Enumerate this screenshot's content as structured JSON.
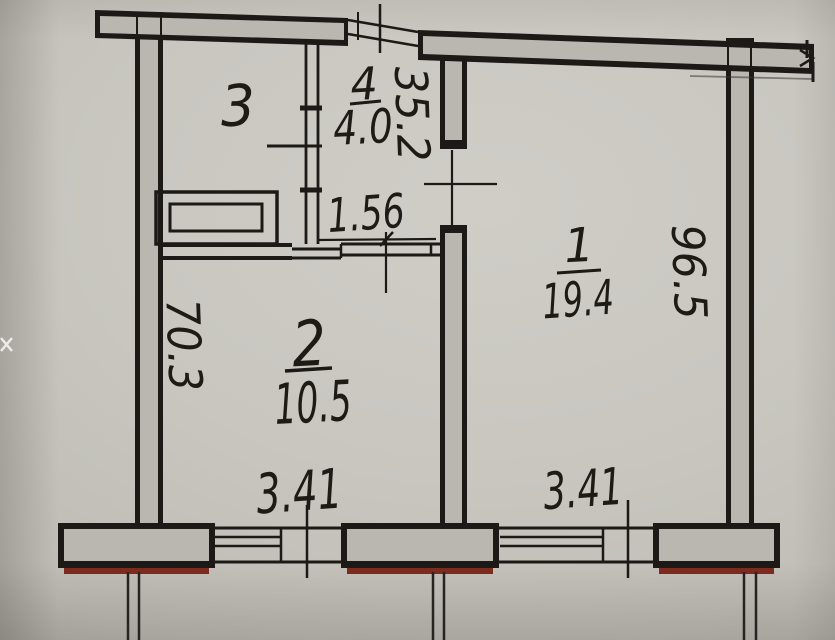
{
  "floor_plan": {
    "rooms": [
      {
        "number": "1",
        "area": "19.4"
      },
      {
        "number": "2",
        "area": "10.5"
      },
      {
        "number": "3"
      },
      {
        "number": "4",
        "area": "4.0"
      }
    ],
    "dimensions": {
      "room4_width": "1.56",
      "room4_depth": "2.53",
      "room1_depth": "5.69",
      "room2_depth": "3.07",
      "room2_window_width": "3.41",
      "room1_window_width": "3.41"
    },
    "colors": {
      "ink": "#1c1916",
      "wall_fill": "#bab7b1",
      "paper": "#c9c6c0",
      "window_sill_red": "#7d2b1e"
    }
  }
}
